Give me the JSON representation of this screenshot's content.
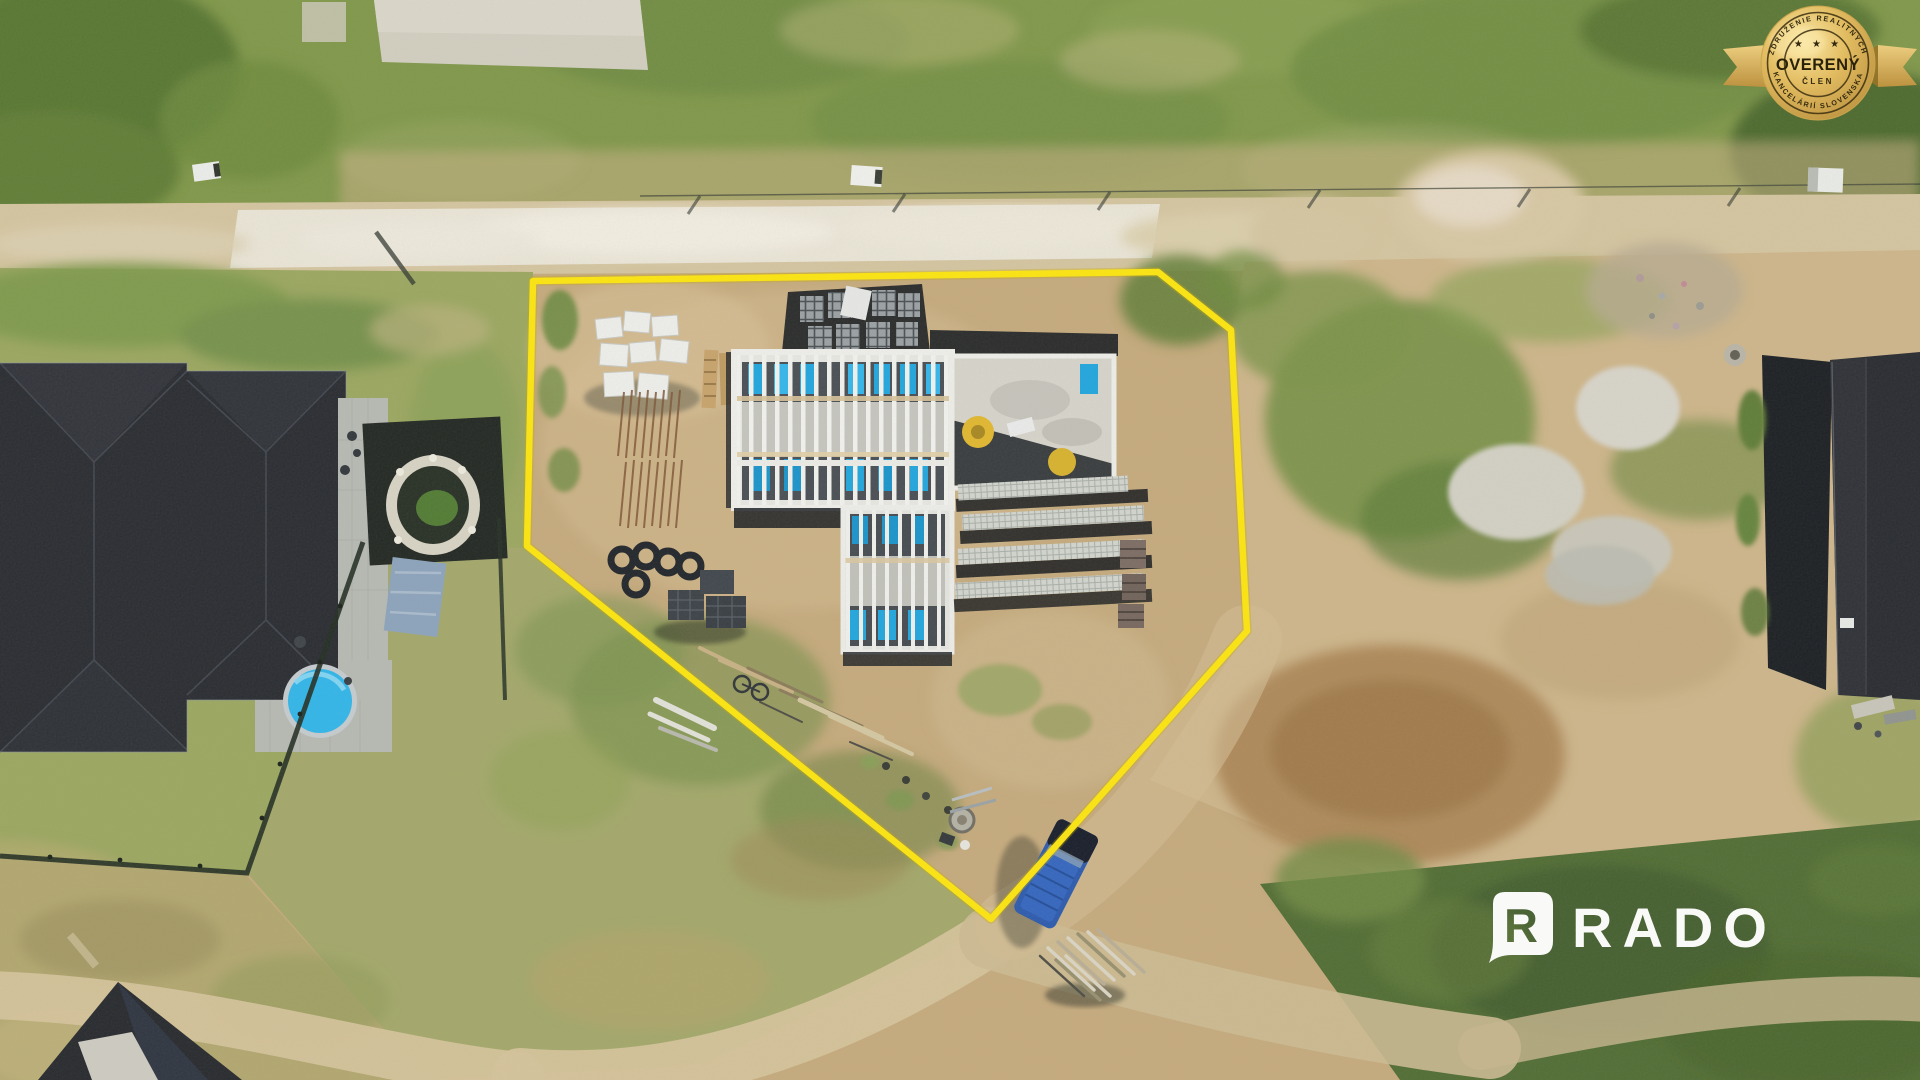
{
  "scene": {
    "description": "Aerial drone photo of a building plot under construction outlined in yellow, neighbouring houses, gravel road and fields"
  },
  "boundary": {
    "color": "#ffe70a"
  },
  "badge": {
    "arc_top": "ZDRUŽENIE REALITNÝCH",
    "stars": "★ ★ ★",
    "title": "OVERENÝ",
    "subtitle": "ČLEN",
    "arc_bottom": "KANCELÁRIÍ SLOVENSKA",
    "gold": "#d9b45f",
    "text_color": "#332a10"
  },
  "watermark": {
    "brand": "RADO",
    "initial": "R",
    "color": "#ffffff"
  },
  "colors": {
    "sand": "#c6aa7c",
    "grass": "#7e9747",
    "gravel_road": "#ece7d9",
    "dark_roof": "#24272d",
    "pool_blue": "#2db6ec",
    "van_blue": "#2757ae",
    "panel_blue": "#1ca6e0"
  }
}
